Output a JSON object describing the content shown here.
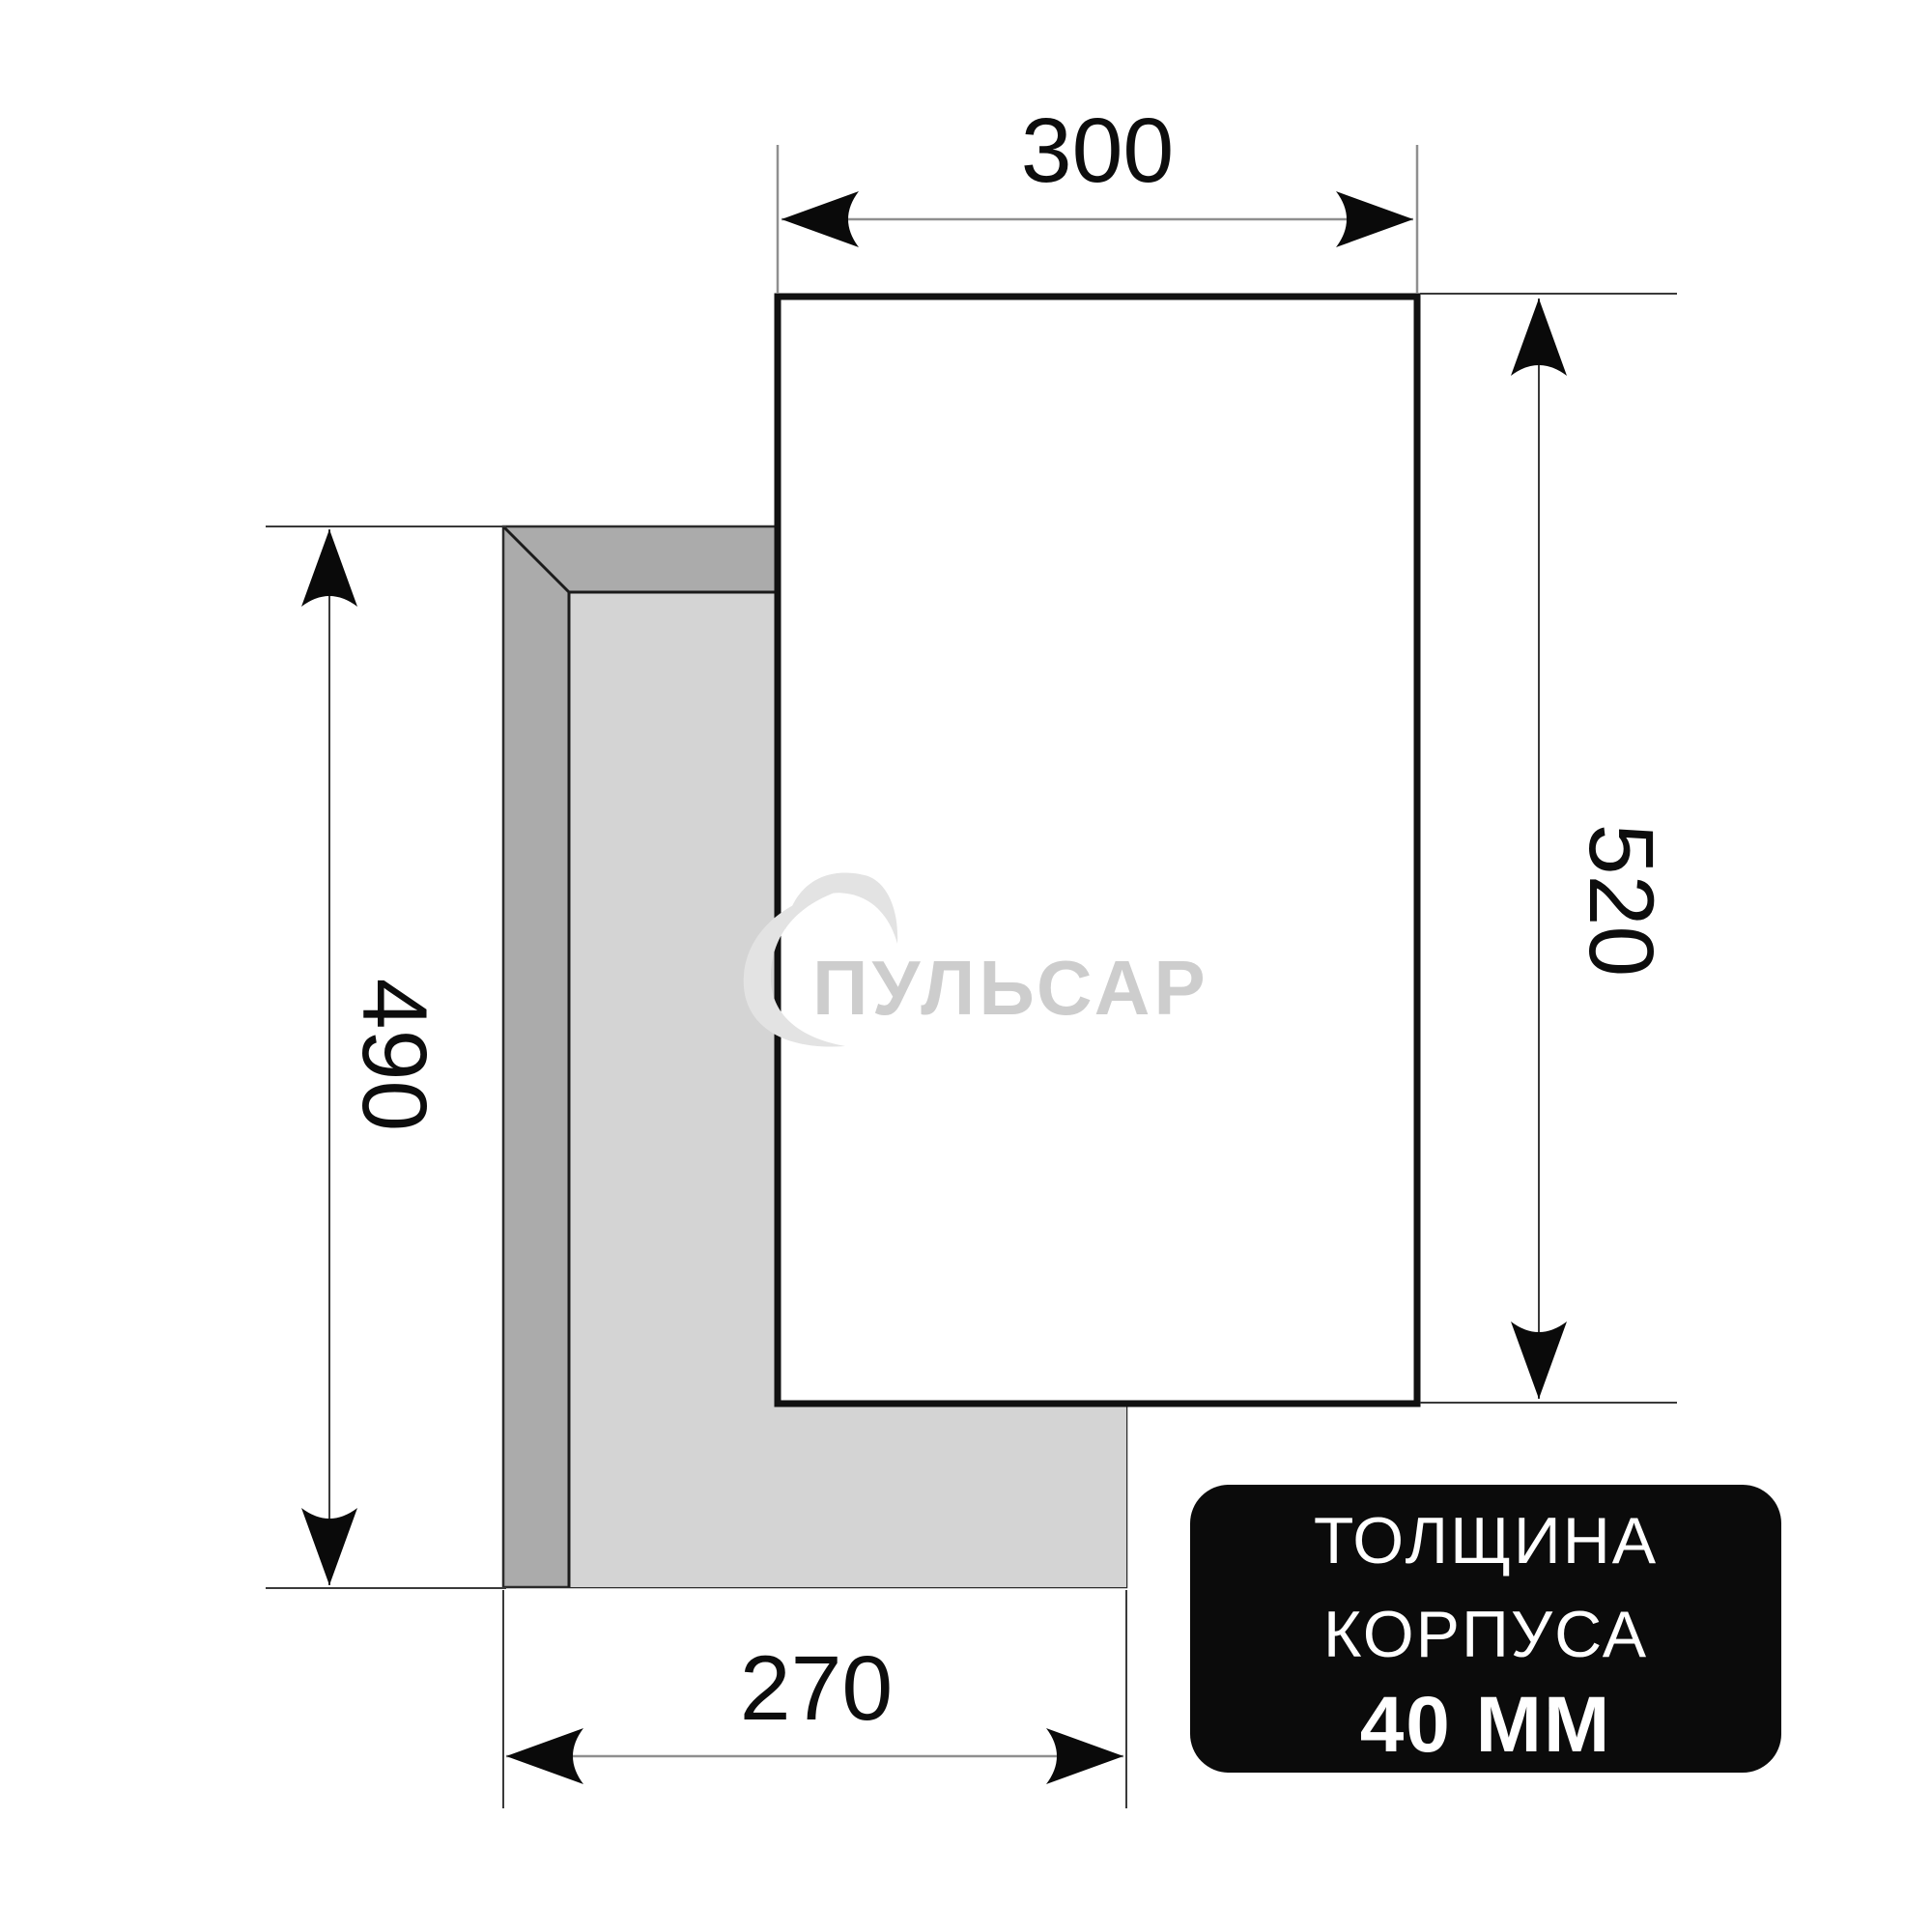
{
  "watermark": {
    "brand": "ПУЛЬСАР"
  },
  "dimensions": {
    "top": {
      "label": "300"
    },
    "right": {
      "label": "520"
    },
    "left": {
      "label": "490"
    },
    "bottom": {
      "label": "270"
    }
  },
  "badge": {
    "line1": "ТОЛЩИНА",
    "line2": "КОРПУСА",
    "line3": "40 ММ"
  },
  "colors": {
    "background": "#ffffff",
    "body_outline": "#111111",
    "cutout_frame_gray": "#ababab",
    "cutout_panel_gray": "#d4d4d4",
    "bevel_outline": "#1b1b1b",
    "dim_line_gray": "#8f8f8f",
    "dim_line_dark": "#3a3a3a",
    "arrow_black": "#0a0a0a",
    "dim_text": "#0d0d0d",
    "watermark_text_gray": "#cdcdcd",
    "watermark_swirl_gray": "#e3e3e3",
    "badge_background": "#0b0b0b",
    "badge_text": "#ffffff"
  }
}
